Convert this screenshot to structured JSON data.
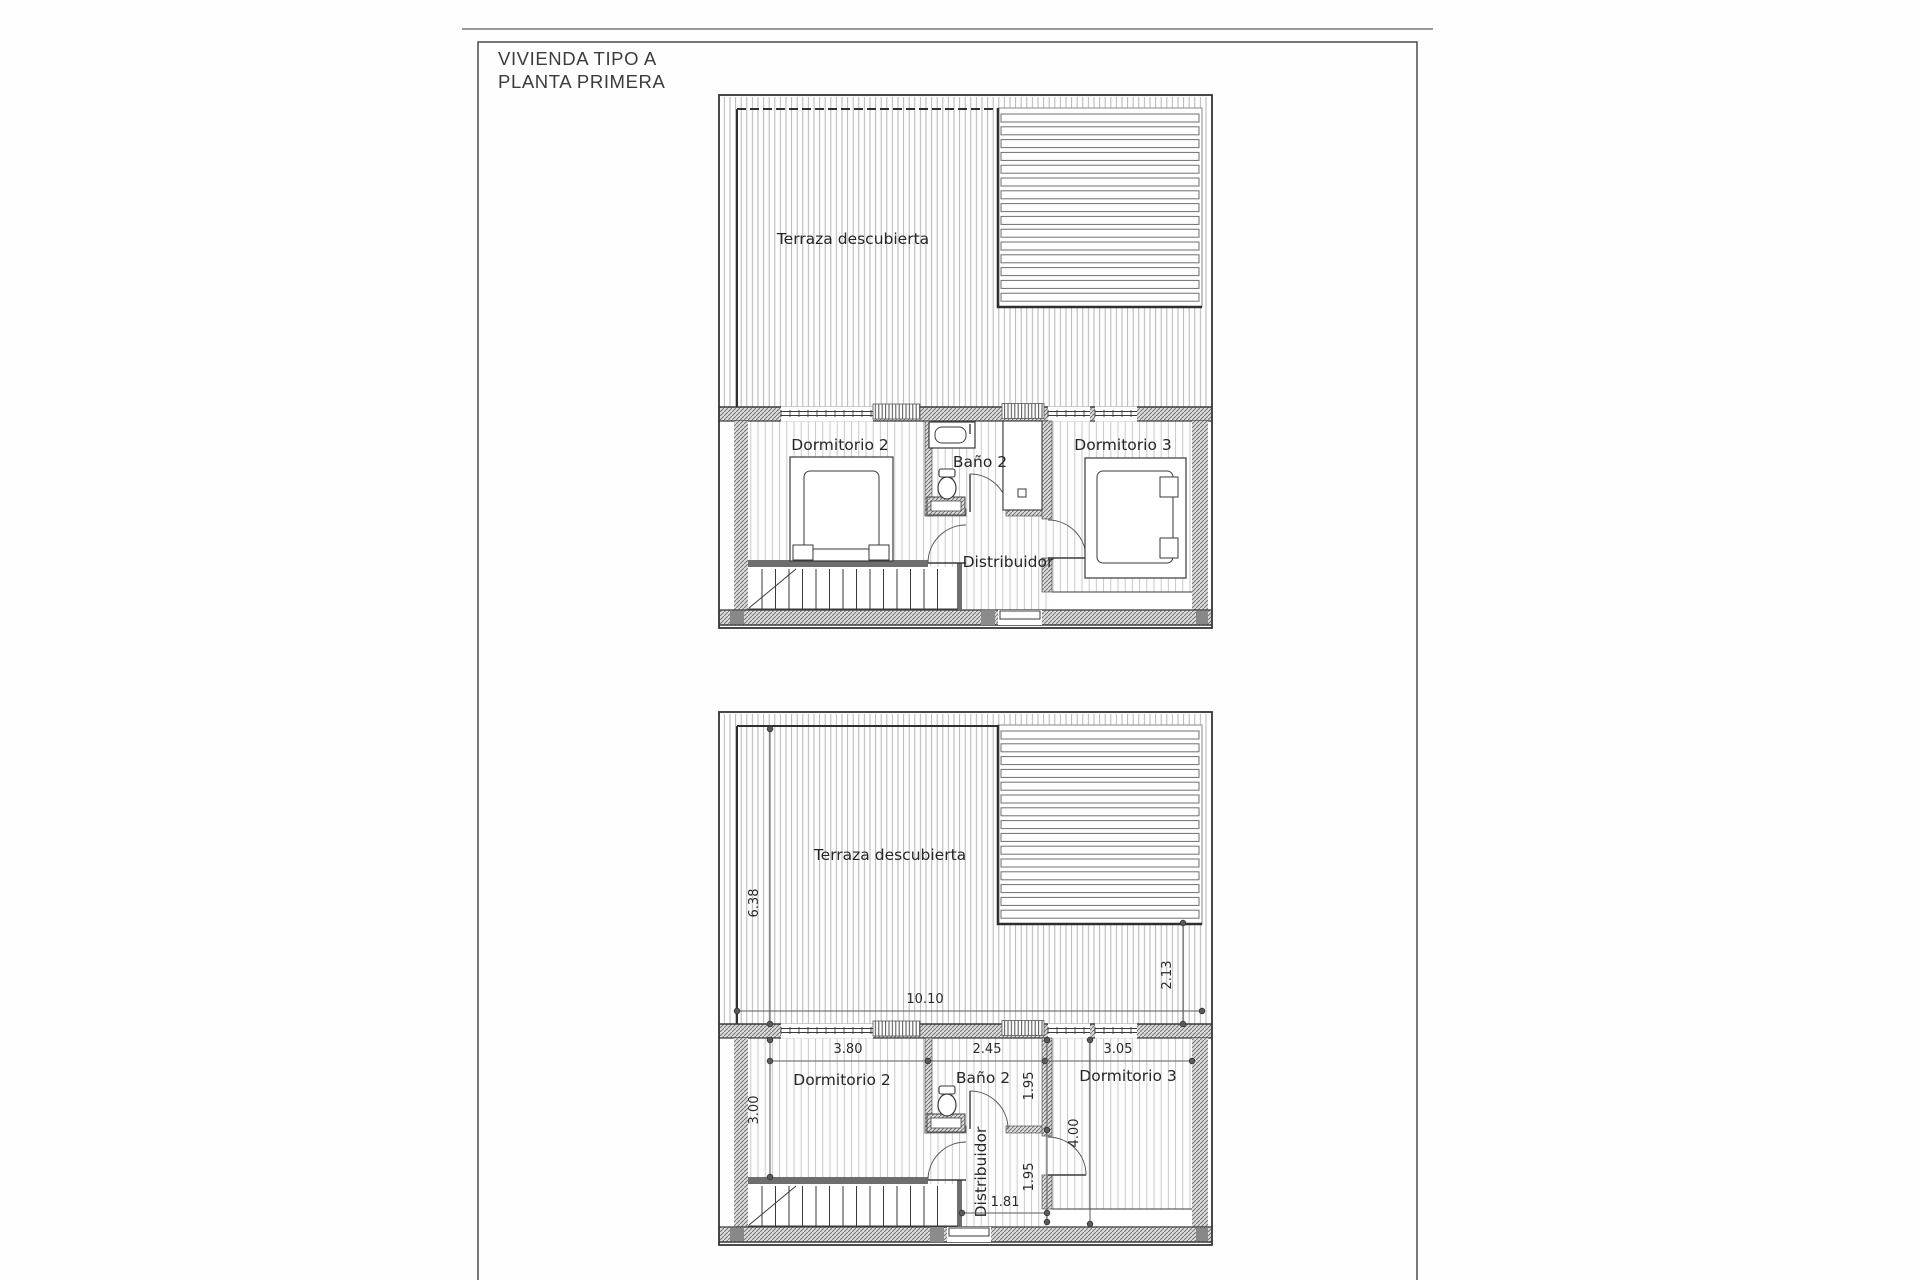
{
  "document": {
    "type": "architectural floor plan scan",
    "ink_color": "#3a3a3a",
    "paper_color": "#fefefe"
  },
  "title": {
    "line1": "VIVIENDA TIPO A",
    "line2": "PLANTA PRIMERA"
  },
  "plans": {
    "top": {
      "name": "furnished plan",
      "labels": {
        "terraza": "Terraza descubierta",
        "dorm2": "Dormitorio 2",
        "bano": "Baño 2",
        "dorm3": "Dormitorio 3",
        "distribuidor": "Distribuidor"
      }
    },
    "bottom": {
      "name": "dimensioned plan",
      "labels": {
        "terraza": "Terraza descubierta",
        "dorm2": "Dormitorio 2",
        "bano": "Baño 2",
        "dorm3": "Dormitorio 3",
        "distribuidor": "Distribuidor"
      },
      "dimensions": {
        "terrace_height": "6.38",
        "terrace_width": "10.10",
        "terrace_right_depth": "2.13",
        "dorm2_width": "3.80",
        "bano_width": "2.45",
        "dorm3_width": "3.05",
        "dorm2_depth": "3.00",
        "bano_depth": "1.95",
        "distribuidor_depth": "1.95",
        "distribuidor_width": "1.81",
        "dorm3_depth": "4.00"
      }
    }
  }
}
